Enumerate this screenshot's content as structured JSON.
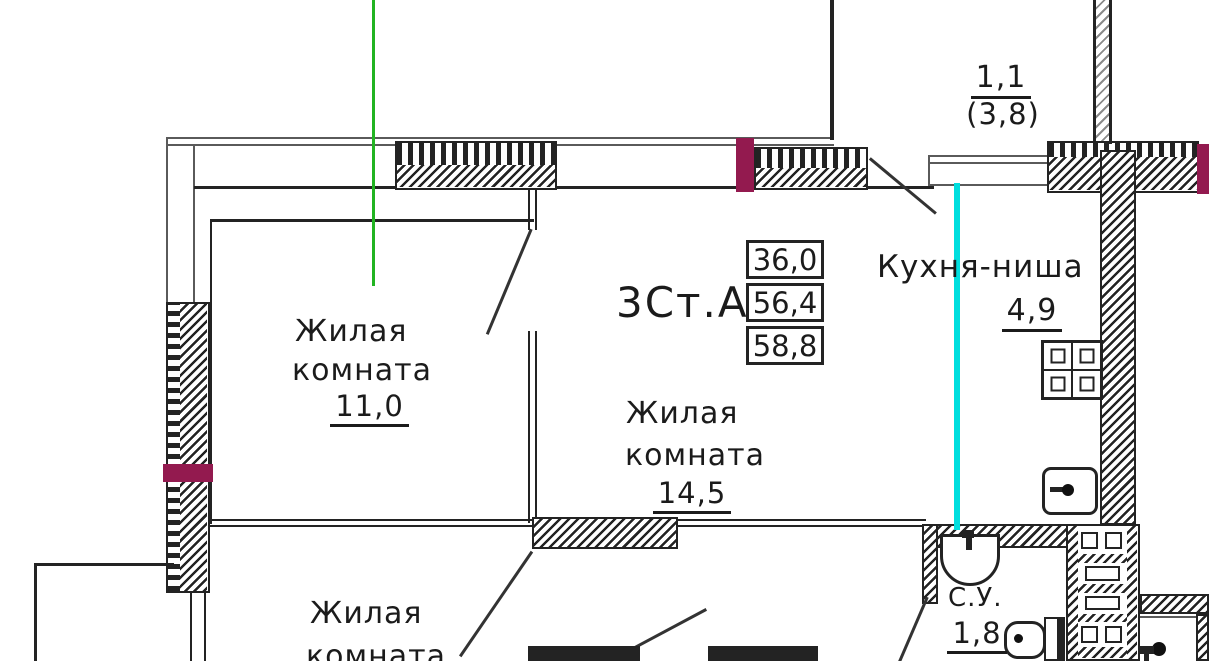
{
  "colors": {
    "line": "#232323",
    "thin": "#5a5a5a",
    "maroon": "#931a4f",
    "green": "#22b422",
    "cyan": "#00dede",
    "bg": "#ffffff"
  },
  "unit": {
    "type_label": "3Ст.А",
    "areas": [
      "36,0",
      "56,4",
      "58,8"
    ]
  },
  "labels": {
    "balcony_area": "1,1",
    "balcony_area_alt": "(3,8)",
    "kitchen_name": "Кухня-ниша",
    "kitchen_area": "4,9",
    "room1_line1": "Жилая",
    "room1_line2": "комната",
    "room1_area": "11,0",
    "room2_line1": "Жилая",
    "room2_line2": "комната",
    "room2_area": "14,5",
    "room3_line1": "Жилая",
    "room3_line2": "комната",
    "bath_name": "С.У.",
    "bath_area": "1,8"
  }
}
